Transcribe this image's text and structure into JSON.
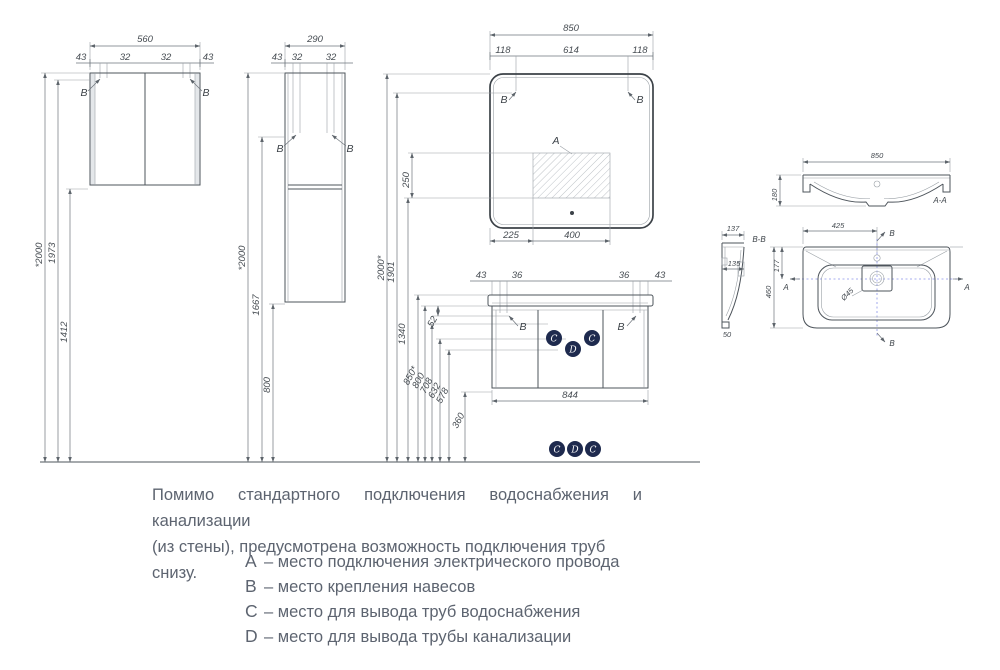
{
  "letters": {
    "a": "A",
    "b": "B",
    "c": "C",
    "d": "D"
  },
  "wall_cabinet": {
    "width": "560",
    "edge_l": "43",
    "hinge_l": "32",
    "hinge_r": "32",
    "edge_r": "43",
    "h_total": "*2000",
    "h_mount": "1973",
    "h_bottom": "1412"
  },
  "tall_cabinet": {
    "width": "290",
    "edge_l": "43",
    "hinge_l": "32",
    "hinge_r": "32",
    "h_total": "*2000",
    "h_mount": "1667",
    "h_bottom": "800"
  },
  "mirror": {
    "width": "850",
    "edge_l": "118",
    "center": "614",
    "edge_r": "118",
    "bottom_l": "225",
    "bottom_c": "400",
    "h_total": "2000*",
    "h_mount": "1901",
    "h_area": "250",
    "h_area_bottom": "1340"
  },
  "vanity": {
    "edge_l": "43",
    "hinge_l": "36",
    "hinge_r": "36",
    "edge_r": "43",
    "width": "844",
    "gap": "52",
    "h_top": "850*",
    "h_carcass": "800",
    "h_supply": "708",
    "h_drain": "632",
    "h_bottom": "578",
    "h_low": "360"
  },
  "section_aa": {
    "label": "A-A",
    "width": "850",
    "height": "180"
  },
  "section_bb": {
    "label": "B-B",
    "depth": "137",
    "mid": "135",
    "foot": "50"
  },
  "plan_view": {
    "half_width": "425",
    "front": "177",
    "depth": "460",
    "drain": "Ø45"
  },
  "note": {
    "line1": "Помимо  стандартного  подключения  водоснабжения  и  канализации",
    "line2": "(из стены), предусмотрена возможность подключения труб снизу."
  },
  "legend": {
    "items": [
      {
        "key": "A",
        "text": "– место подключения электрического провода"
      },
      {
        "key": "B",
        "text": "– место крепления навесов"
      },
      {
        "key": "C",
        "text": "– место для вывода труб водоснабжения"
      },
      {
        "key": "D",
        "text": "– место для вывода трубы канализации"
      }
    ]
  }
}
